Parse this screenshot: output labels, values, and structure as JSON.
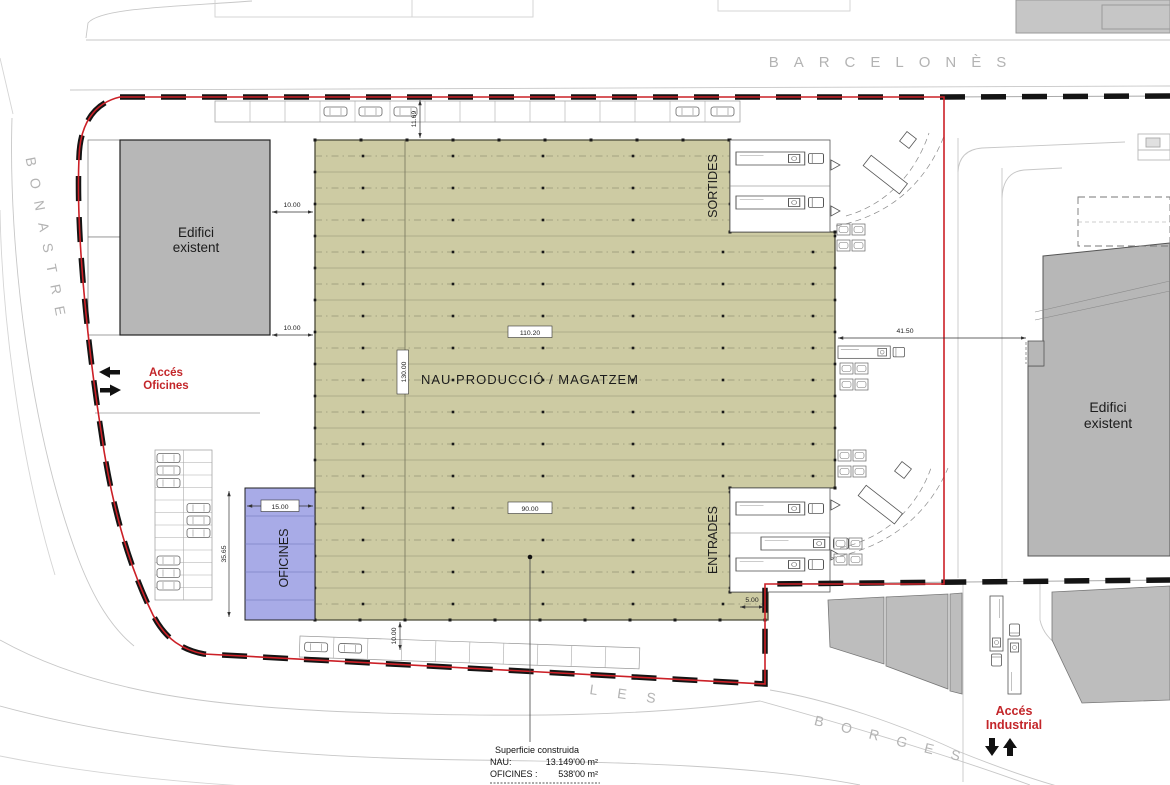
{
  "streets": {
    "top": "BARCELONÈS",
    "left": "BONASTRE",
    "bottom_word1": "LES",
    "bottom_word2": "BORGES"
  },
  "buildings": {
    "nau_label": "NAU PRODUCCIÓ / MAGATZEM",
    "oficines_label": "OFICINES",
    "sortides_label": "SORTIDES",
    "entrades_label": "ENTRADES",
    "edifici_left_line1": "Edifici",
    "edifici_left_line2": "existent",
    "edifici_right_line1": "Edifici",
    "edifici_right_line2": "existent"
  },
  "access": {
    "oficines_line1": "Accés",
    "oficines_line2": "Oficines",
    "industrial_line1": "Accés",
    "industrial_line2": "Industrial"
  },
  "dimensions": {
    "nau_width": "110.20",
    "nau_height": "130.00",
    "entrades_width": "90.00",
    "oficines_width": "15.00",
    "oficines_height": "35.65",
    "gap_left_top": "10.00",
    "gap_left_bottom": "10.00",
    "gap_top": "11.69",
    "gap_bottom": "10.00",
    "gap_right": "41.50",
    "gap_southeast": "5.00"
  },
  "summary": {
    "title": "Superficie construida",
    "rows": [
      {
        "label": "NAU:",
        "value": "13.149'00  m²"
      },
      {
        "label": "OFICINES :",
        "value": "538'00 m²"
      }
    ]
  },
  "colors": {
    "nau_fill": "#cdcba3",
    "oficines_fill": "#a8abe7",
    "existing_fill": "#b7b7b7",
    "boundary_red": "#cc2027",
    "accent_red": "#c3262a",
    "street_text": "#b3b3b3"
  }
}
